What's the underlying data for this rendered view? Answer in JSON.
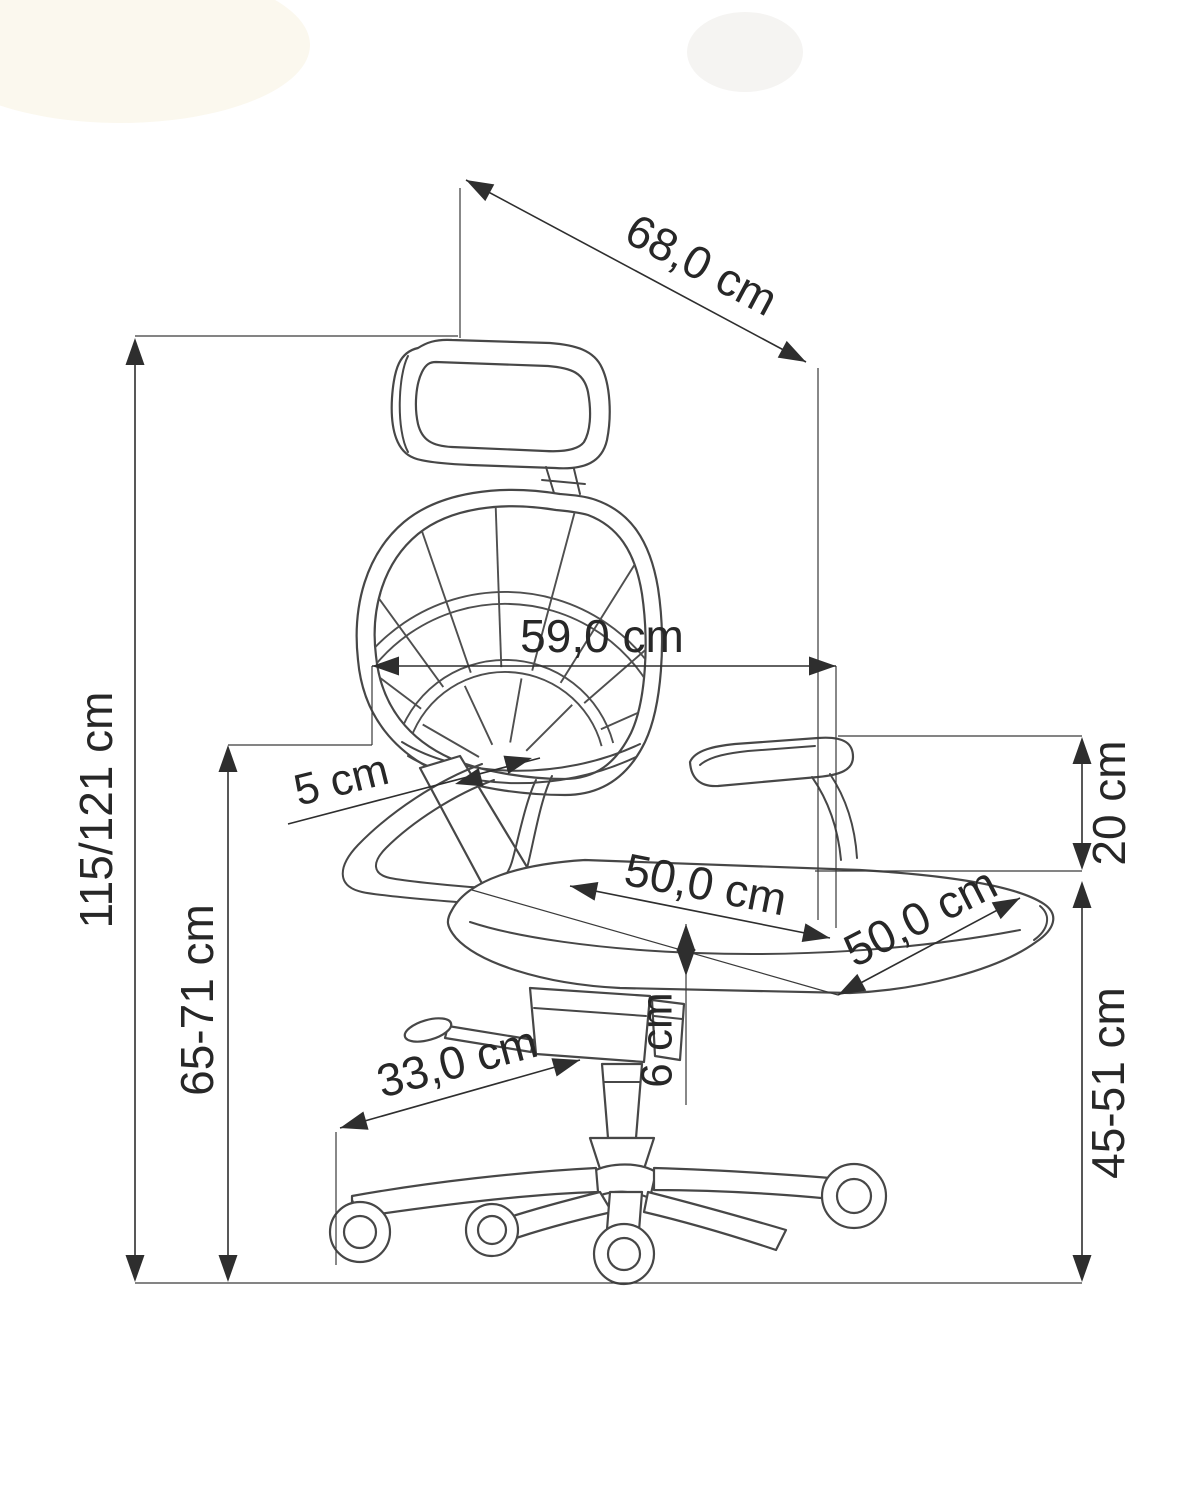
{
  "diagram": {
    "subject": "Office chair technical dimension drawing, side view",
    "units": "cm",
    "line_color": "#2e2e2e",
    "dimensions": {
      "overall_height": "115/121 cm",
      "armrest_height_from_floor": "65-71 cm",
      "headrest_diagonal_depth": "68,0 cm",
      "backrest_width": "59,0 cm",
      "armrest_pad_adjustment": "5 cm",
      "seat_width": "50,0 cm",
      "seat_depth": "50,0 cm",
      "seat_cushion_thickness": "6 cm",
      "base_leg_length": "33,0 cm",
      "backrest_to_seat_gap": "20 cm",
      "seat_height": "45-51 cm"
    }
  }
}
